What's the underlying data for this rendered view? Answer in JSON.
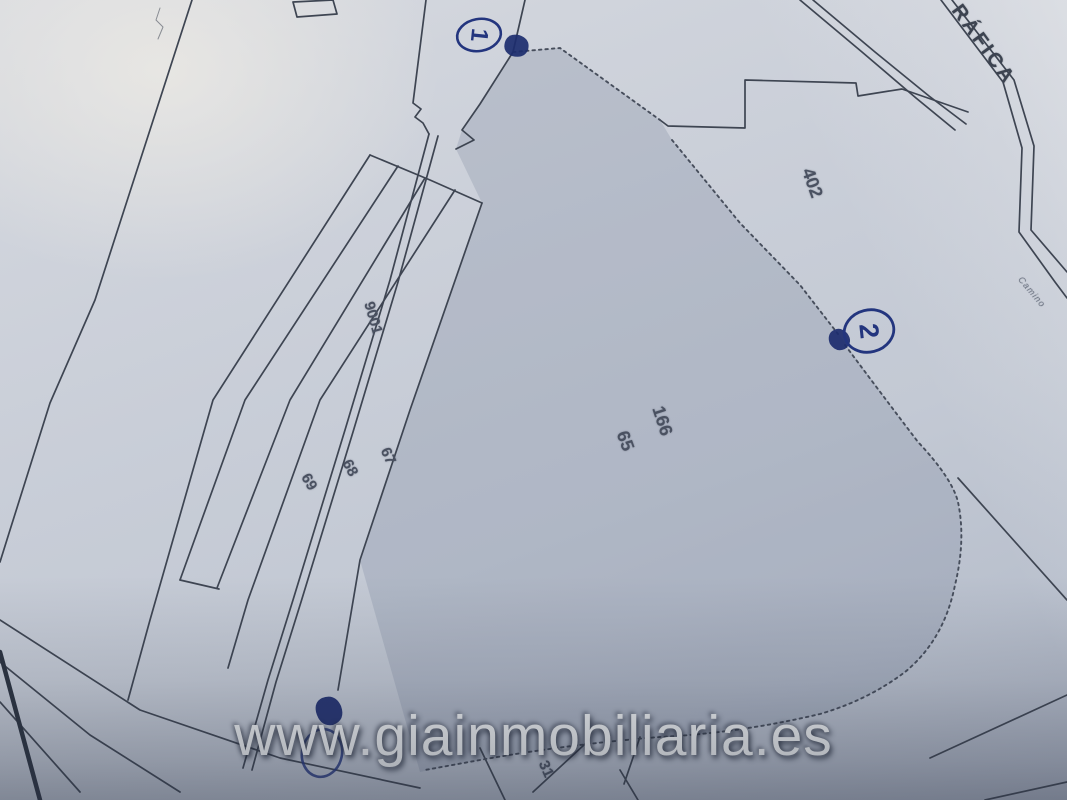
{
  "map": {
    "parcel_labels": [
      {
        "id": "402",
        "text": "402"
      },
      {
        "id": "166",
        "text": "166"
      },
      {
        "id": "65",
        "text": "65"
      },
      {
        "id": "9001",
        "text": "9001"
      },
      {
        "id": "67",
        "text": "67"
      },
      {
        "id": "68",
        "text": "68"
      },
      {
        "id": "69",
        "text": "69"
      },
      {
        "id": "31",
        "text": "31"
      }
    ],
    "road_labels": [
      {
        "id": "grafica",
        "text": "RÁFICA"
      },
      {
        "id": "camino",
        "text": "Camino"
      }
    ],
    "annotations": [
      {
        "id": "point-1",
        "text": "1"
      },
      {
        "id": "point-2",
        "text": "2"
      }
    ]
  },
  "watermark": {
    "text": "www.giainmobiliaria.es"
  },
  "colors": {
    "ink": "#3e4552",
    "blue_ink": "#23357e",
    "paper": "#c9ced8",
    "parcel_shade": "#aab1c1",
    "watermark_text": "#eef0f1",
    "label_text": "#4a5161"
  }
}
